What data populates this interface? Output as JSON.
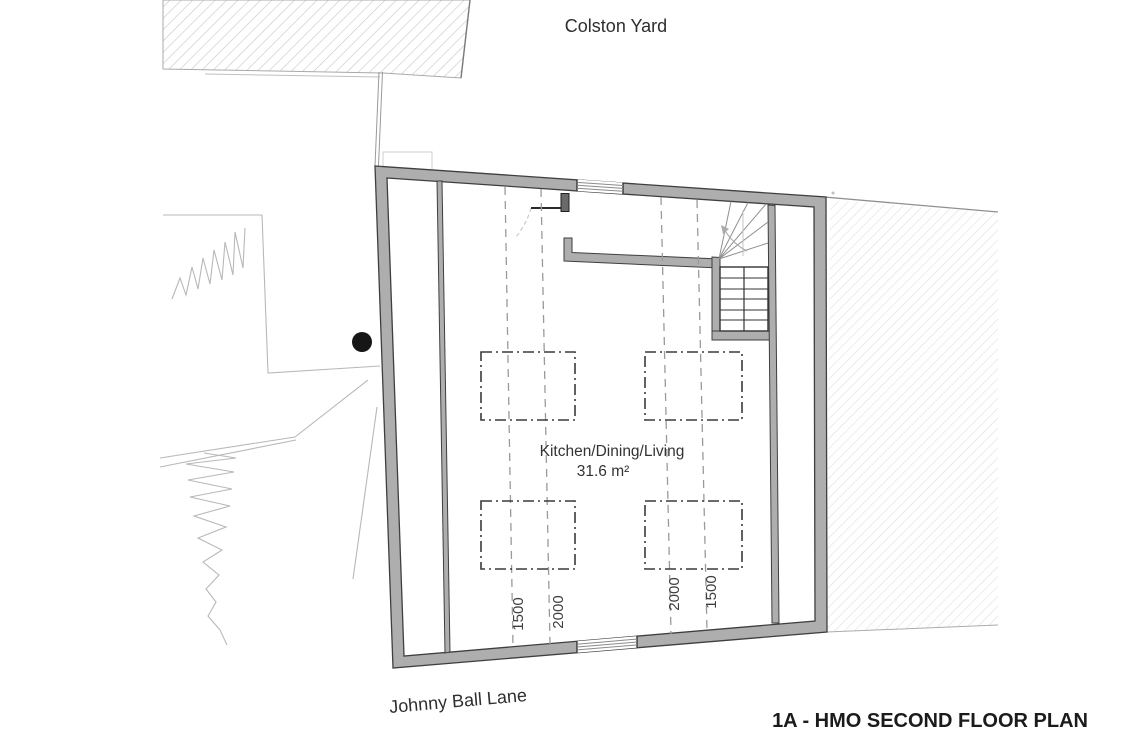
{
  "plan": {
    "street_top": "Colston Yard",
    "street_bottom": "Johnny Ball Lane",
    "drawing_title": "1A - HMO SECOND FLOOR PLAN",
    "room": {
      "name": "Kitchen/Dining/Living",
      "area": "31.6 m²"
    },
    "dimensions": {
      "left_pair": [
        "1500",
        "2000"
      ],
      "right_pair": [
        "2000",
        "1500"
      ]
    },
    "colors": {
      "background": "#ffffff",
      "wall_fill": "#aeaeae",
      "wall_edge": "#3f3f3f",
      "hatch_line_right": "#dcdcdc",
      "hatch_line_top_left": "#c6c6c6",
      "site_line": "#b8b8b8",
      "dashed_dimension_line": "#9a9a9a",
      "table_outline": "#3a3a3a",
      "stair_tread": "#333333",
      "text": "#2e2e2e",
      "survey_dot": "#161616"
    }
  }
}
